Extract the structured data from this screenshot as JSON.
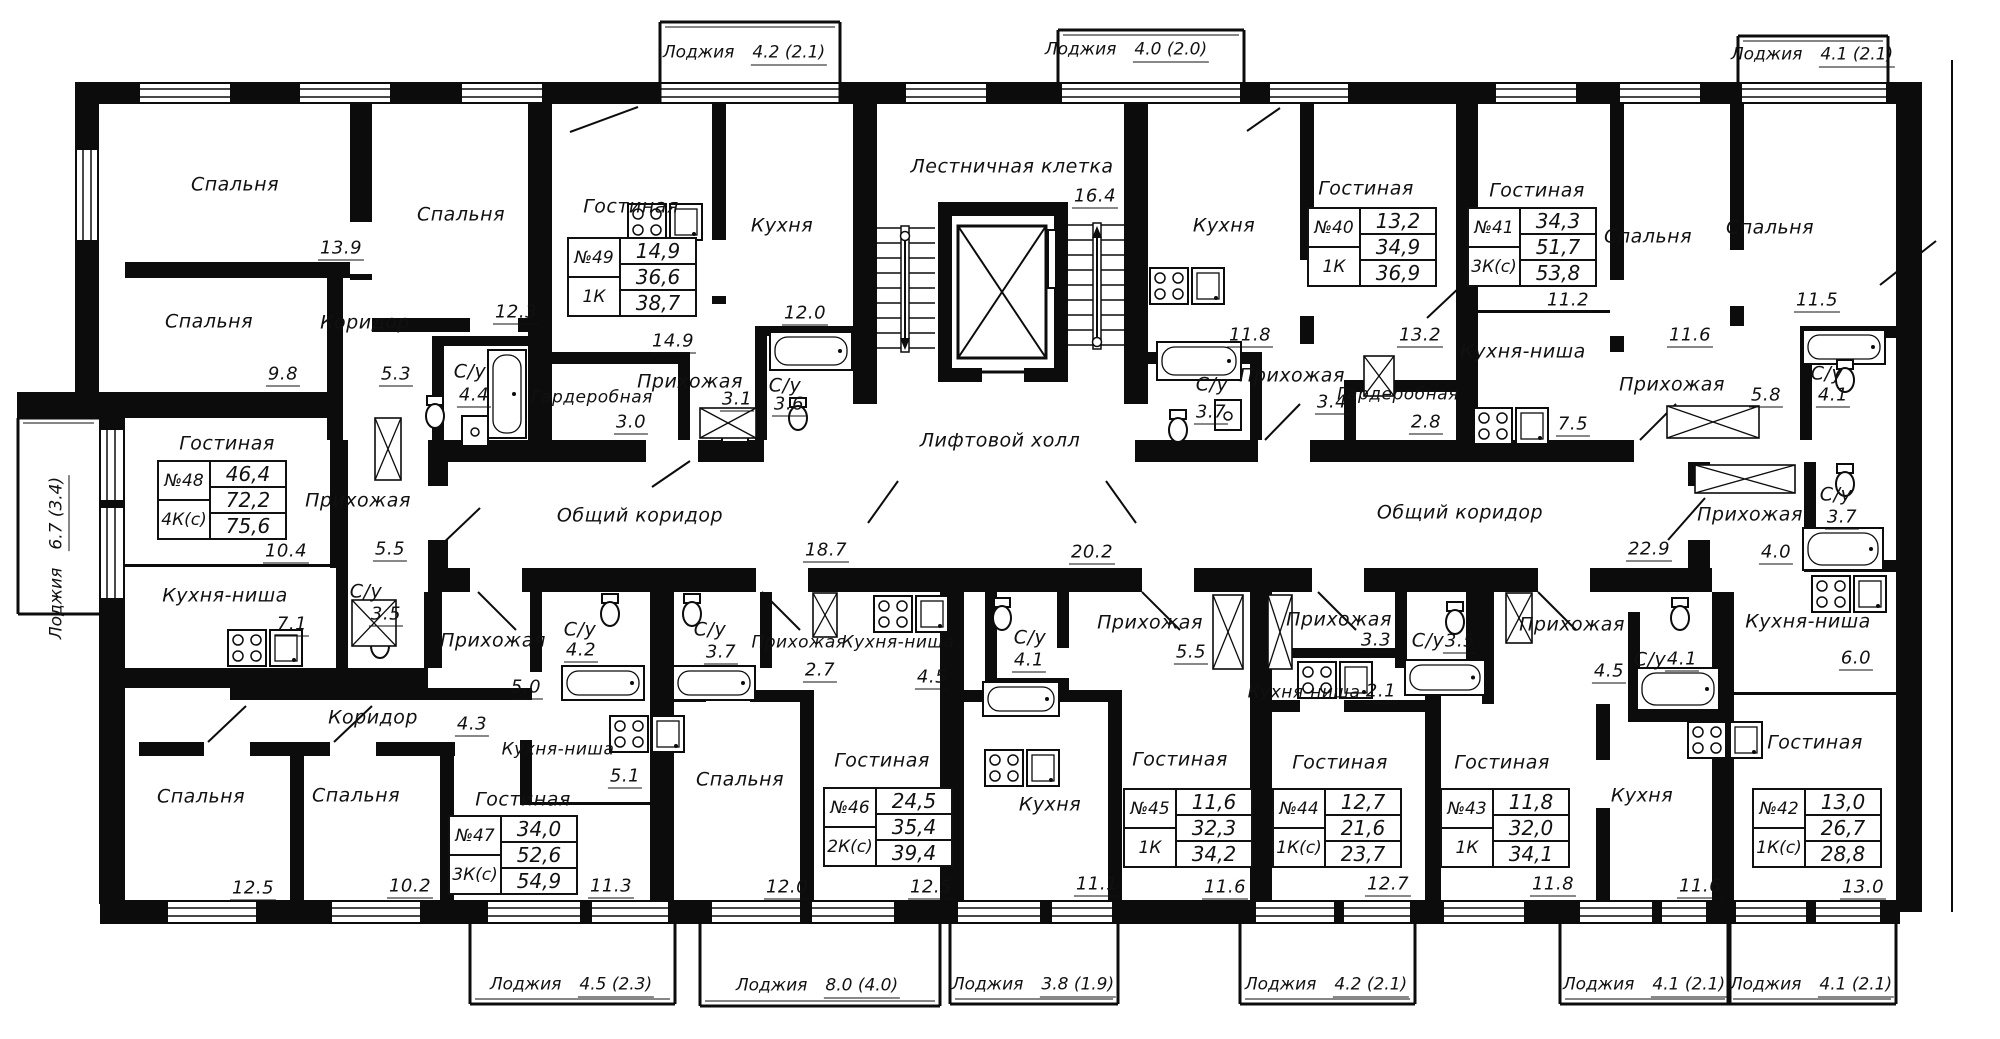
{
  "common": {
    "stairwell": {
      "label": "Лестничная клетка",
      "area": "16.4"
    },
    "elevator_hall": {
      "label": "Лифтовой холл",
      "area": "20.2"
    },
    "corridor_left": {
      "label": "Общий коридор",
      "area": "18.7"
    },
    "corridor_right": {
      "label": "Общий коридор",
      "area": "22.9"
    }
  },
  "loggias": [
    {
      "label": "Лоджия",
      "value": "4.2 (2.1)"
    },
    {
      "label": "Лоджия",
      "value": "4.0 (2.0)"
    },
    {
      "label": "Лоджия",
      "value": "4.1 (2.1)"
    },
    {
      "label": "Лоджия",
      "value": "6.7 (3.4)"
    },
    {
      "label": "Лоджия",
      "value": "4.5 (2.3)"
    },
    {
      "label": "Лоджия",
      "value": "8.0 (4.0)"
    },
    {
      "label": "Лоджия",
      "value": "3.8 (1.9)"
    },
    {
      "label": "Лоджия",
      "value": "4.2 (2.1)"
    },
    {
      "label": "Лоджия",
      "value": "4.1 (2.1)"
    },
    {
      "label": "Лоджия",
      "value": "4.1 (2.1)"
    }
  ],
  "apartments": [
    {
      "number": "№40",
      "type": "1К",
      "living_area": "13,2",
      "total_area": "34,9",
      "total_with_loggia": "36,9",
      "rooms": [
        {
          "label": "Гостиная",
          "area": "13.2"
        },
        {
          "label": "Кухня",
          "area": "11.8"
        },
        {
          "label": "Прихожая",
          "area": "3.4"
        },
        {
          "label": "Гардеробная",
          "area": "2.8"
        },
        {
          "label": "С/у",
          "area": "3.7"
        }
      ]
    },
    {
      "number": "№41",
      "type": "3К(с)",
      "living_area": "34,3",
      "total_area": "51,7",
      "total_with_loggia": "53,8",
      "rooms": [
        {
          "label": "Гостиная",
          "area": "11.2"
        },
        {
          "label": "Кухня-ниша",
          "area": "7.5"
        },
        {
          "label": "Спальня",
          "area": "11.6"
        },
        {
          "label": "Спальня",
          "area": "11.5"
        },
        {
          "label": "Прихожая",
          "area": "5.8"
        },
        {
          "label": "С/у",
          "area": "4.1"
        }
      ]
    },
    {
      "number": "№42",
      "type": "1К(с)",
      "living_area": "13,0",
      "total_area": "26,7",
      "total_with_loggia": "28,8",
      "rooms": [
        {
          "label": "Гостиная",
          "area": "13.0"
        },
        {
          "label": "Кухня-ниша",
          "area": "6.0"
        },
        {
          "label": "Прихожая",
          "area": "4.0"
        },
        {
          "label": "С/у",
          "area": "3.7"
        }
      ]
    },
    {
      "number": "№43",
      "type": "1К",
      "living_area": "11,8",
      "total_area": "32,0",
      "total_with_loggia": "34,1",
      "rooms": [
        {
          "label": "Гостиная",
          "area": "11.8"
        },
        {
          "label": "Кухня",
          "area": "11.6"
        },
        {
          "label": "Прихожая",
          "area": "4.5"
        },
        {
          "label": "С/у",
          "area": "4.1"
        }
      ]
    },
    {
      "number": "№44",
      "type": "1К(с)",
      "living_area": "12,7",
      "total_area": "21,6",
      "total_with_loggia": "23,7",
      "rooms": [
        {
          "label": "Гостиная",
          "area": "12.7"
        },
        {
          "label": "Кухня-ниша",
          "area": "2.1"
        },
        {
          "label": "Прихожая",
          "area": "3.3"
        },
        {
          "label": "С/у",
          "area": "3.5"
        }
      ]
    },
    {
      "number": "№45",
      "type": "1К",
      "living_area": "11,6",
      "total_area": "32,3",
      "total_with_loggia": "34,2",
      "rooms": [
        {
          "label": "Гостиная",
          "area": "11.6"
        },
        {
          "label": "Кухня",
          "area": "11.1"
        },
        {
          "label": "Прихожая",
          "area": "5.5"
        },
        {
          "label": "С/у",
          "area": "4.1"
        }
      ]
    },
    {
      "number": "№46",
      "type": "2К(с)",
      "living_area": "24,5",
      "total_area": "35,4",
      "total_with_loggia": "39,4",
      "rooms": [
        {
          "label": "Гостиная",
          "area": "12.5"
        },
        {
          "label": "Спальня",
          "area": "12.0"
        },
        {
          "label": "Кухня-ниша",
          "area": "4.5"
        },
        {
          "label": "Прихожая",
          "area": "2.7"
        },
        {
          "label": "С/у",
          "area": "3.7"
        }
      ]
    },
    {
      "number": "№47",
      "type": "3К(с)",
      "living_area": "34,0",
      "total_area": "52,6",
      "total_with_loggia": "54,9",
      "rooms": [
        {
          "label": "Гостиная",
          "area": "11.3"
        },
        {
          "label": "Спальня",
          "area": "12.5"
        },
        {
          "label": "Спальня",
          "area": "10.2"
        },
        {
          "label": "Кухня-ниша",
          "area": "5.1"
        },
        {
          "label": "Коридор",
          "area": "4.3"
        },
        {
          "label": "Прихожая",
          "area": "5.0"
        },
        {
          "label": "С/у",
          "area": "4.2"
        }
      ]
    },
    {
      "number": "№48",
      "type": "4К(с)",
      "living_area": "46,4",
      "total_area": "72,2",
      "total_with_loggia": "75,6",
      "rooms": [
        {
          "label": "Гостиная",
          "area": "10.4"
        },
        {
          "label": "Спальня",
          "area": "13.9"
        },
        {
          "label": "Спальня",
          "area": "9.8"
        },
        {
          "label": "Спальня",
          "area": "12.3"
        },
        {
          "label": "Коридор",
          "area": "5.3"
        },
        {
          "label": "С/у",
          "area": "4.4"
        },
        {
          "label": "Прихожая",
          "area": "5.5"
        },
        {
          "label": "Кухня-ниша",
          "area": "7.1"
        },
        {
          "label": "С/у",
          "area": "3.5"
        }
      ]
    },
    {
      "number": "№49",
      "type": "1К",
      "living_area": "14,9",
      "total_area": "36,6",
      "total_with_loggia": "38,7",
      "rooms": [
        {
          "label": "Гостиная",
          "area": "14.9"
        },
        {
          "label": "Кухня",
          "area": "12.0"
        },
        {
          "label": "Прихожая",
          "area": "3.1"
        },
        {
          "label": "С/у",
          "area": "3.6"
        },
        {
          "label": "Гардеробная",
          "area": "3.0"
        }
      ]
    }
  ]
}
